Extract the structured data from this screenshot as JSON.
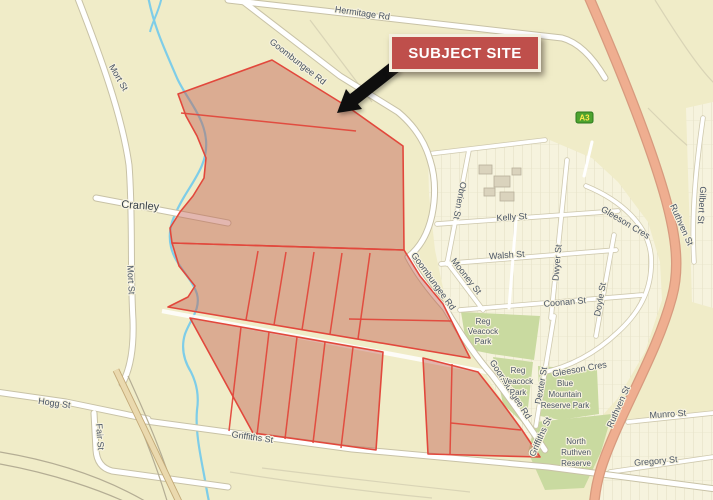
{
  "annotation": {
    "title": "SUBJECT SITE"
  },
  "locality": {
    "name": "Cranley"
  },
  "route_marker": {
    "label": "A3"
  },
  "streets": {
    "hermitage": "Hermitage Rd",
    "goombungee": "Goombungee Rd",
    "mort": "Mort St",
    "hogg": "Hogg St",
    "fair": "Fair St",
    "griffiths": "Griffiths St",
    "kelly": "Kelly St",
    "walsh": "Walsh St",
    "coonan": "Coonan St",
    "obrien": "Obrien St",
    "mooney": "Mooney St",
    "dwyer": "Dwyer St",
    "doyle": "Doyle St",
    "dexter": "Dexter St",
    "gleeson": "Gleeson Cres",
    "ruthven": "Ruthven St",
    "munro": "Munro St",
    "gregory": "Gregory St",
    "gilbert": "Gilbert St"
  },
  "parks": {
    "reg_veacock": [
      "Reg",
      "Veacock",
      "Park"
    ],
    "blue_mountain": [
      "Blue",
      "Mountain",
      "Reserve Park"
    ],
    "north_ruthven": [
      "North",
      "Ruthven",
      "Reserve"
    ]
  },
  "colors": {
    "background": "#f0ecc8",
    "urban_block": "#f6f3de",
    "site_fill": "#c0604f",
    "site_border": "#e2483c",
    "park": "#c9daa0",
    "creek": "#7ecde8",
    "highway": "#efae90",
    "annotation_bg": "#bf4f4b",
    "annotation_border": "#f3efdf",
    "annotation_text": "#ffffff",
    "route_marker_bg": "#4da32f",
    "route_marker_text": "#ffe94d"
  }
}
